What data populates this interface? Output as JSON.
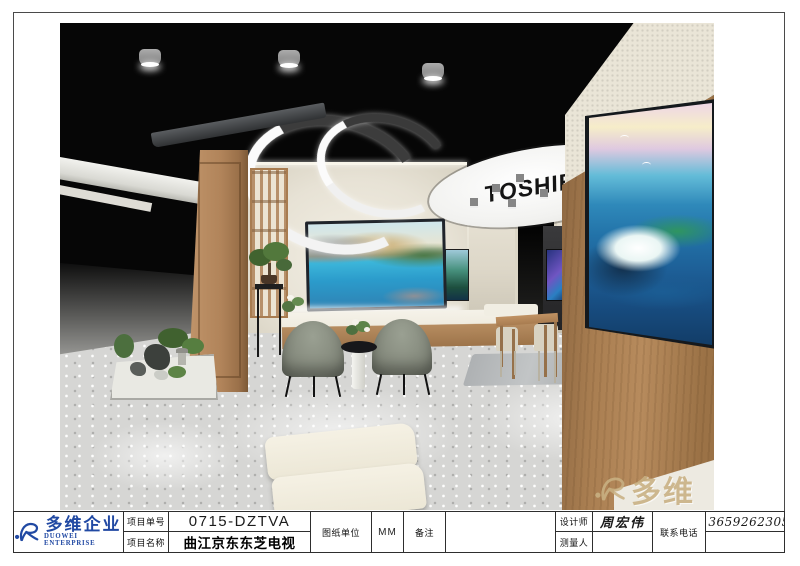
{
  "sheet": {
    "brand_text": "TOSHIBA",
    "watermark_text": "多维"
  },
  "title_block": {
    "company": {
      "name_cn": "多维企业",
      "name_en": "DUOWEI ENTERPRISE"
    },
    "project_no_label": "项目单号",
    "project_no_value": "0715-DZTVA",
    "project_name_label": "项目名称",
    "project_name_value": "曲江京东东芝电视",
    "drawing_unit_label": "图纸单位",
    "drawing_unit_value": "MM",
    "remarks_label": "备注",
    "remarks_value": "",
    "designer_label": "设计师",
    "designer_value": "周宏伟",
    "surveyor_label": "测量人",
    "surveyor_value": "",
    "phone_label": "联系电话",
    "phone_value": "13659262305"
  },
  "colors": {
    "logo_blue": "#2149a3",
    "watermark_tan": "#c9b183",
    "ceiling_black": "#060606",
    "wall_cream": "#eae6db",
    "wood": "#ab7f52",
    "floor_gray": "#d6d6d4"
  }
}
